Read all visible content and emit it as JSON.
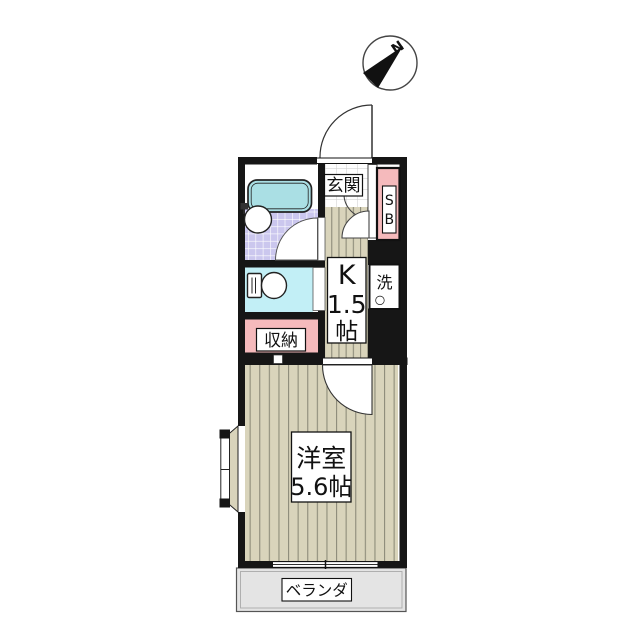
{
  "title": "apartment-floor-plan",
  "compass": {
    "north_label": "N"
  },
  "rooms": {
    "genkan": {
      "label": "玄関"
    },
    "kitchen": {
      "line1": "K",
      "line2": "1.5",
      "line3": "帖"
    },
    "main_room": {
      "line1": "洋室",
      "line2": "5.6帖"
    },
    "closet": {
      "label": "収納"
    },
    "veranda": {
      "label": "ベランダ"
    },
    "shoebox": {
      "line1": "S",
      "line2": "B"
    },
    "laundry": {
      "label": "洗",
      "drain_mark": "○"
    }
  },
  "fixtures": {
    "bathtub": "bathtub-icon",
    "washbasin": "washbasin-icon",
    "toilet": "toilet-icon",
    "bay_window": "bay-window",
    "sliding_window": "sliding-window",
    "entrance_door": "entrance-door-arc"
  },
  "colors": {
    "wall": "#161616",
    "floor_tan": "#d9d4bb",
    "floor_stripe": "#8e8c7a",
    "bath_tile_lavender": "#cbc7ee",
    "bathtub_teal": "#aadfe4",
    "toilet_cyan": "#c2eff6",
    "storage_pink": "#f5babc",
    "veranda_gray": "#e4e4e4",
    "label_bg": "#ffffff"
  }
}
